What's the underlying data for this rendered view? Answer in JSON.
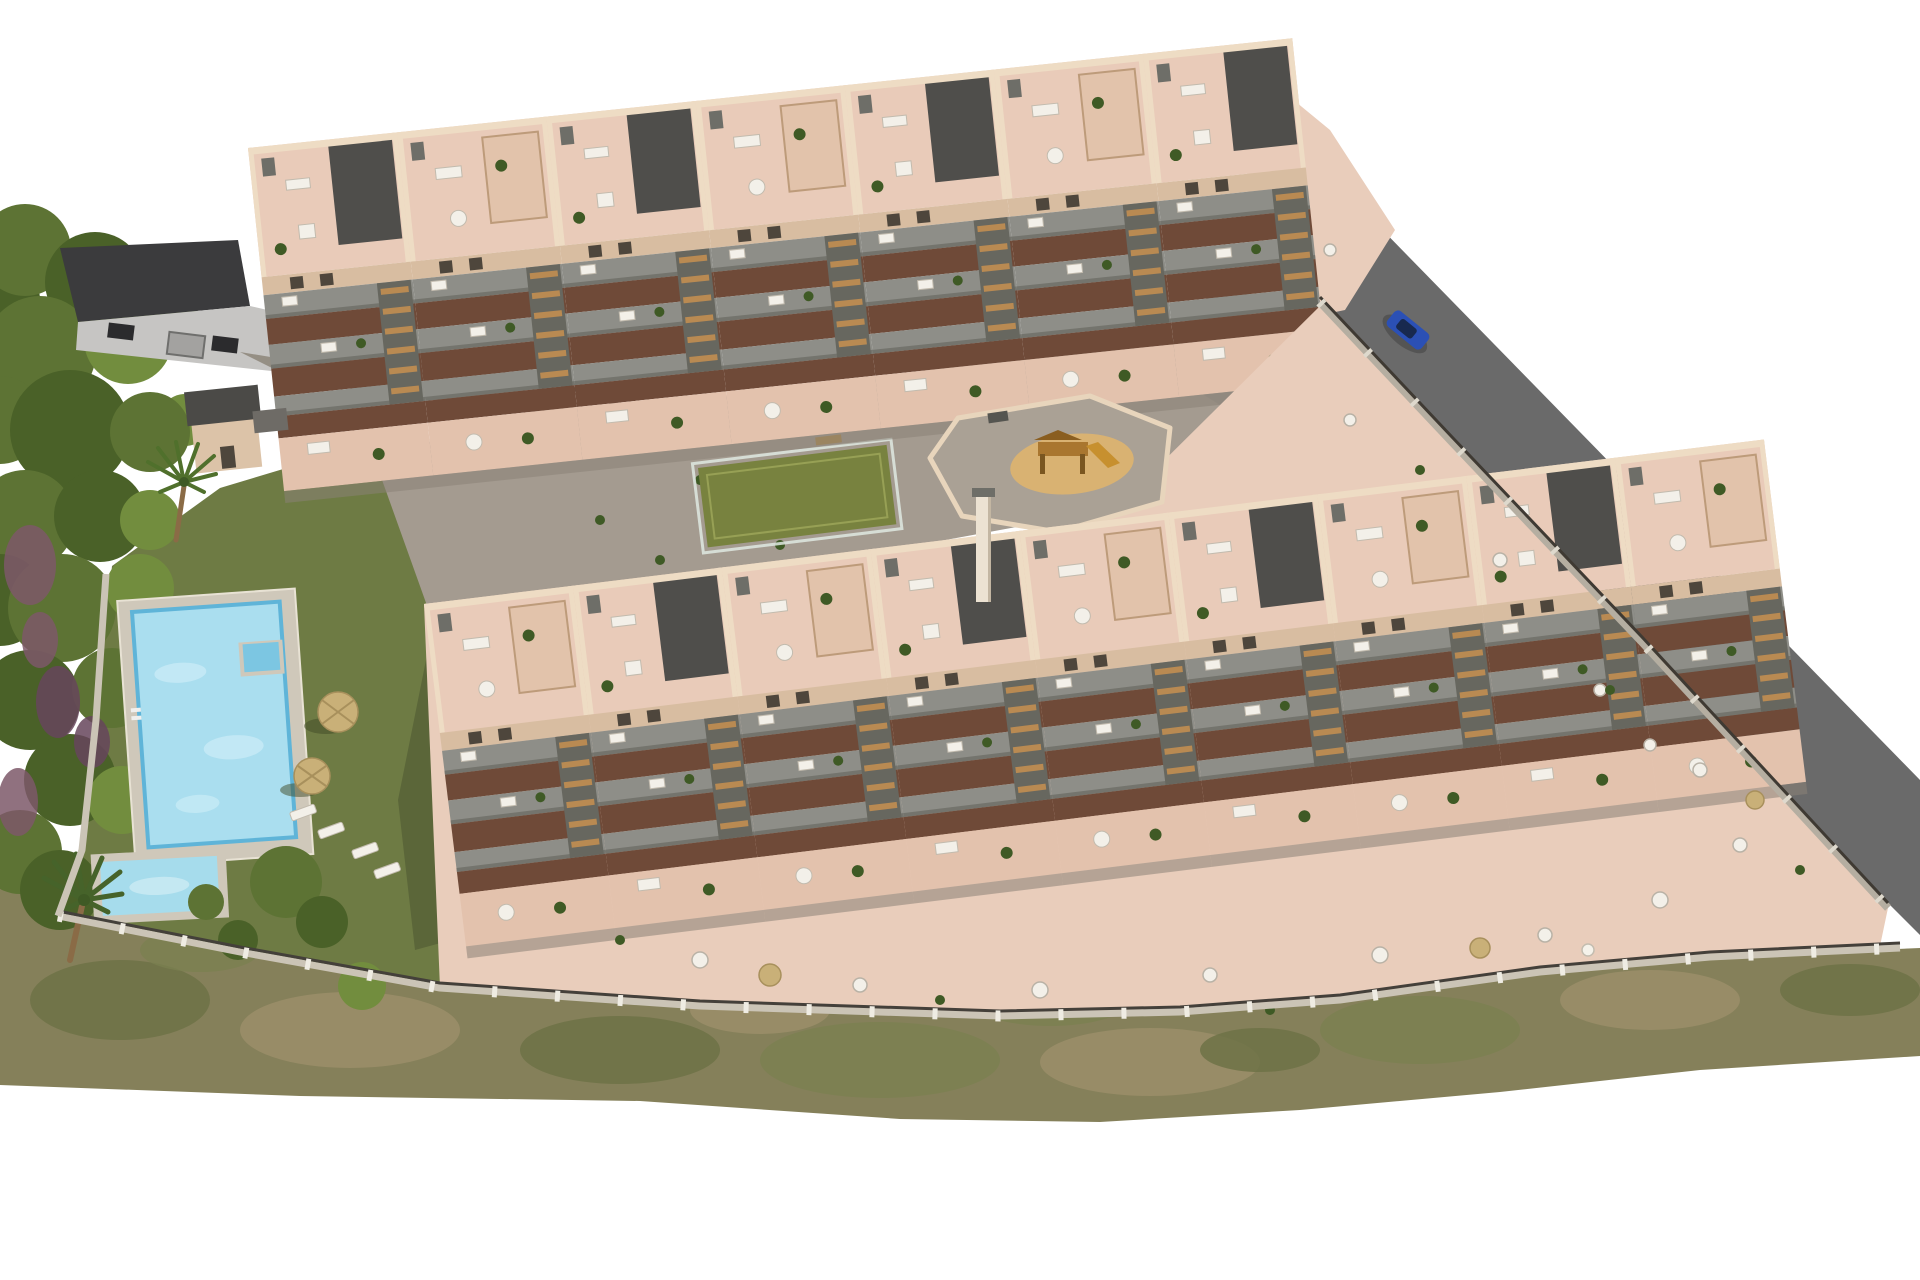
{
  "meta": {
    "title": "Aerial 3D render of a new-build apartment complex",
    "image_type": "architectural-visualization",
    "view": "aerial-oblique",
    "canvas": {
      "width": 1920,
      "height": 1280
    }
  },
  "scene": {
    "background": "#ffffff",
    "objects": [
      {
        "name": "upper-apartment-block",
        "description": "Stepped diagonal row of beige townhouse units with pink roof terraces, grey tiered balconies, dark flat roofs and external stairs",
        "units": 7
      },
      {
        "name": "lower-apartment-block",
        "description": "Second stepped row of identical units with ground-floor terraces reaching the boundary fence",
        "units": 9
      },
      {
        "name": "garden-lawn",
        "description": "Olive-green communal lawn west of the buildings"
      },
      {
        "name": "swimming-pool",
        "description": "Rectangular lap pool with corner step recess, ladder and light stone sun deck"
      },
      {
        "name": "kids-pool",
        "description": "Small rectangular children's pool below the main pool"
      },
      {
        "name": "pool-house",
        "description": "Small flat-roofed outbuilding at the top of the pool garden"
      },
      {
        "name": "parasols",
        "description": "Straw parasols with white sun loungers on the lawn",
        "count": 2
      },
      {
        "name": "sports-court",
        "description": "Green multi-use court enclosed by a glass fence with bench"
      },
      {
        "name": "playground",
        "description": "Walled play area with circular sand pit and wooden climbing frame with slide"
      },
      {
        "name": "central-plaza",
        "description": "Grey paved communal plaza with planters between the two blocks"
      },
      {
        "name": "access-road",
        "description": "Dark asphalt road running along the north-east boundary"
      },
      {
        "name": "parked-car",
        "description": "Blue car parked on the access road",
        "count": 1
      },
      {
        "name": "neighbor-building",
        "description": "Neighbouring dark-roofed building with grey wall, windows and gate at the top left"
      },
      {
        "name": "boundary-fence",
        "description": "Light stone wall with posts and dark railing around the plot"
      },
      {
        "name": "woodland",
        "description": "Dense green trees with purple flowering shrubs along the west edge"
      },
      {
        "name": "scrubland",
        "description": "Dry brush strip along the south-west boundary"
      },
      {
        "name": "palm-trees",
        "description": "Palm trees in the pool garden",
        "count": 2
      }
    ]
  },
  "colors": {
    "background": "#ffffff",
    "lawn": "#6e7b44",
    "scrub": "#85805a",
    "road": "#6a6a6a",
    "road_apron": "#9a9389",
    "plaza": "#a49b90",
    "court": "#78823f",
    "sand": "#d9b272",
    "pool_water": "#aadeef",
    "pool_deep": "#5fb4d8",
    "pool_steps": "#7cc6e2",
    "kids_pool_water": "#a6dcec",
    "deck": "#cfc8ba",
    "terrace_base": "#e9cdbb",
    "roof_terrace": "#e9cbb9",
    "facade": "#d8bda1",
    "parapet": "#eedcc4",
    "balcony": "#8e8e88",
    "balcony_shadow": "#6f4a38",
    "charcoal_roof": "#4f4e4b",
    "stair_wood": "#b98a52",
    "car": "#2b50b5",
    "glass_fence": "#dfe9e2",
    "fence_stone": "#cbc4b6",
    "fence_rail": "#44403a",
    "umbrella": "#c9b078",
    "furniture_white": "#f3f0e9",
    "tree_dark": "#4a6128",
    "tree_mid": "#5d7334",
    "tree_light": "#728d3e",
    "heather": "#7d5868",
    "neighbor_roof": "#3b3b3d",
    "neighbor_wall": "#c6c5c3",
    "play_wood": "#a9762f"
  }
}
